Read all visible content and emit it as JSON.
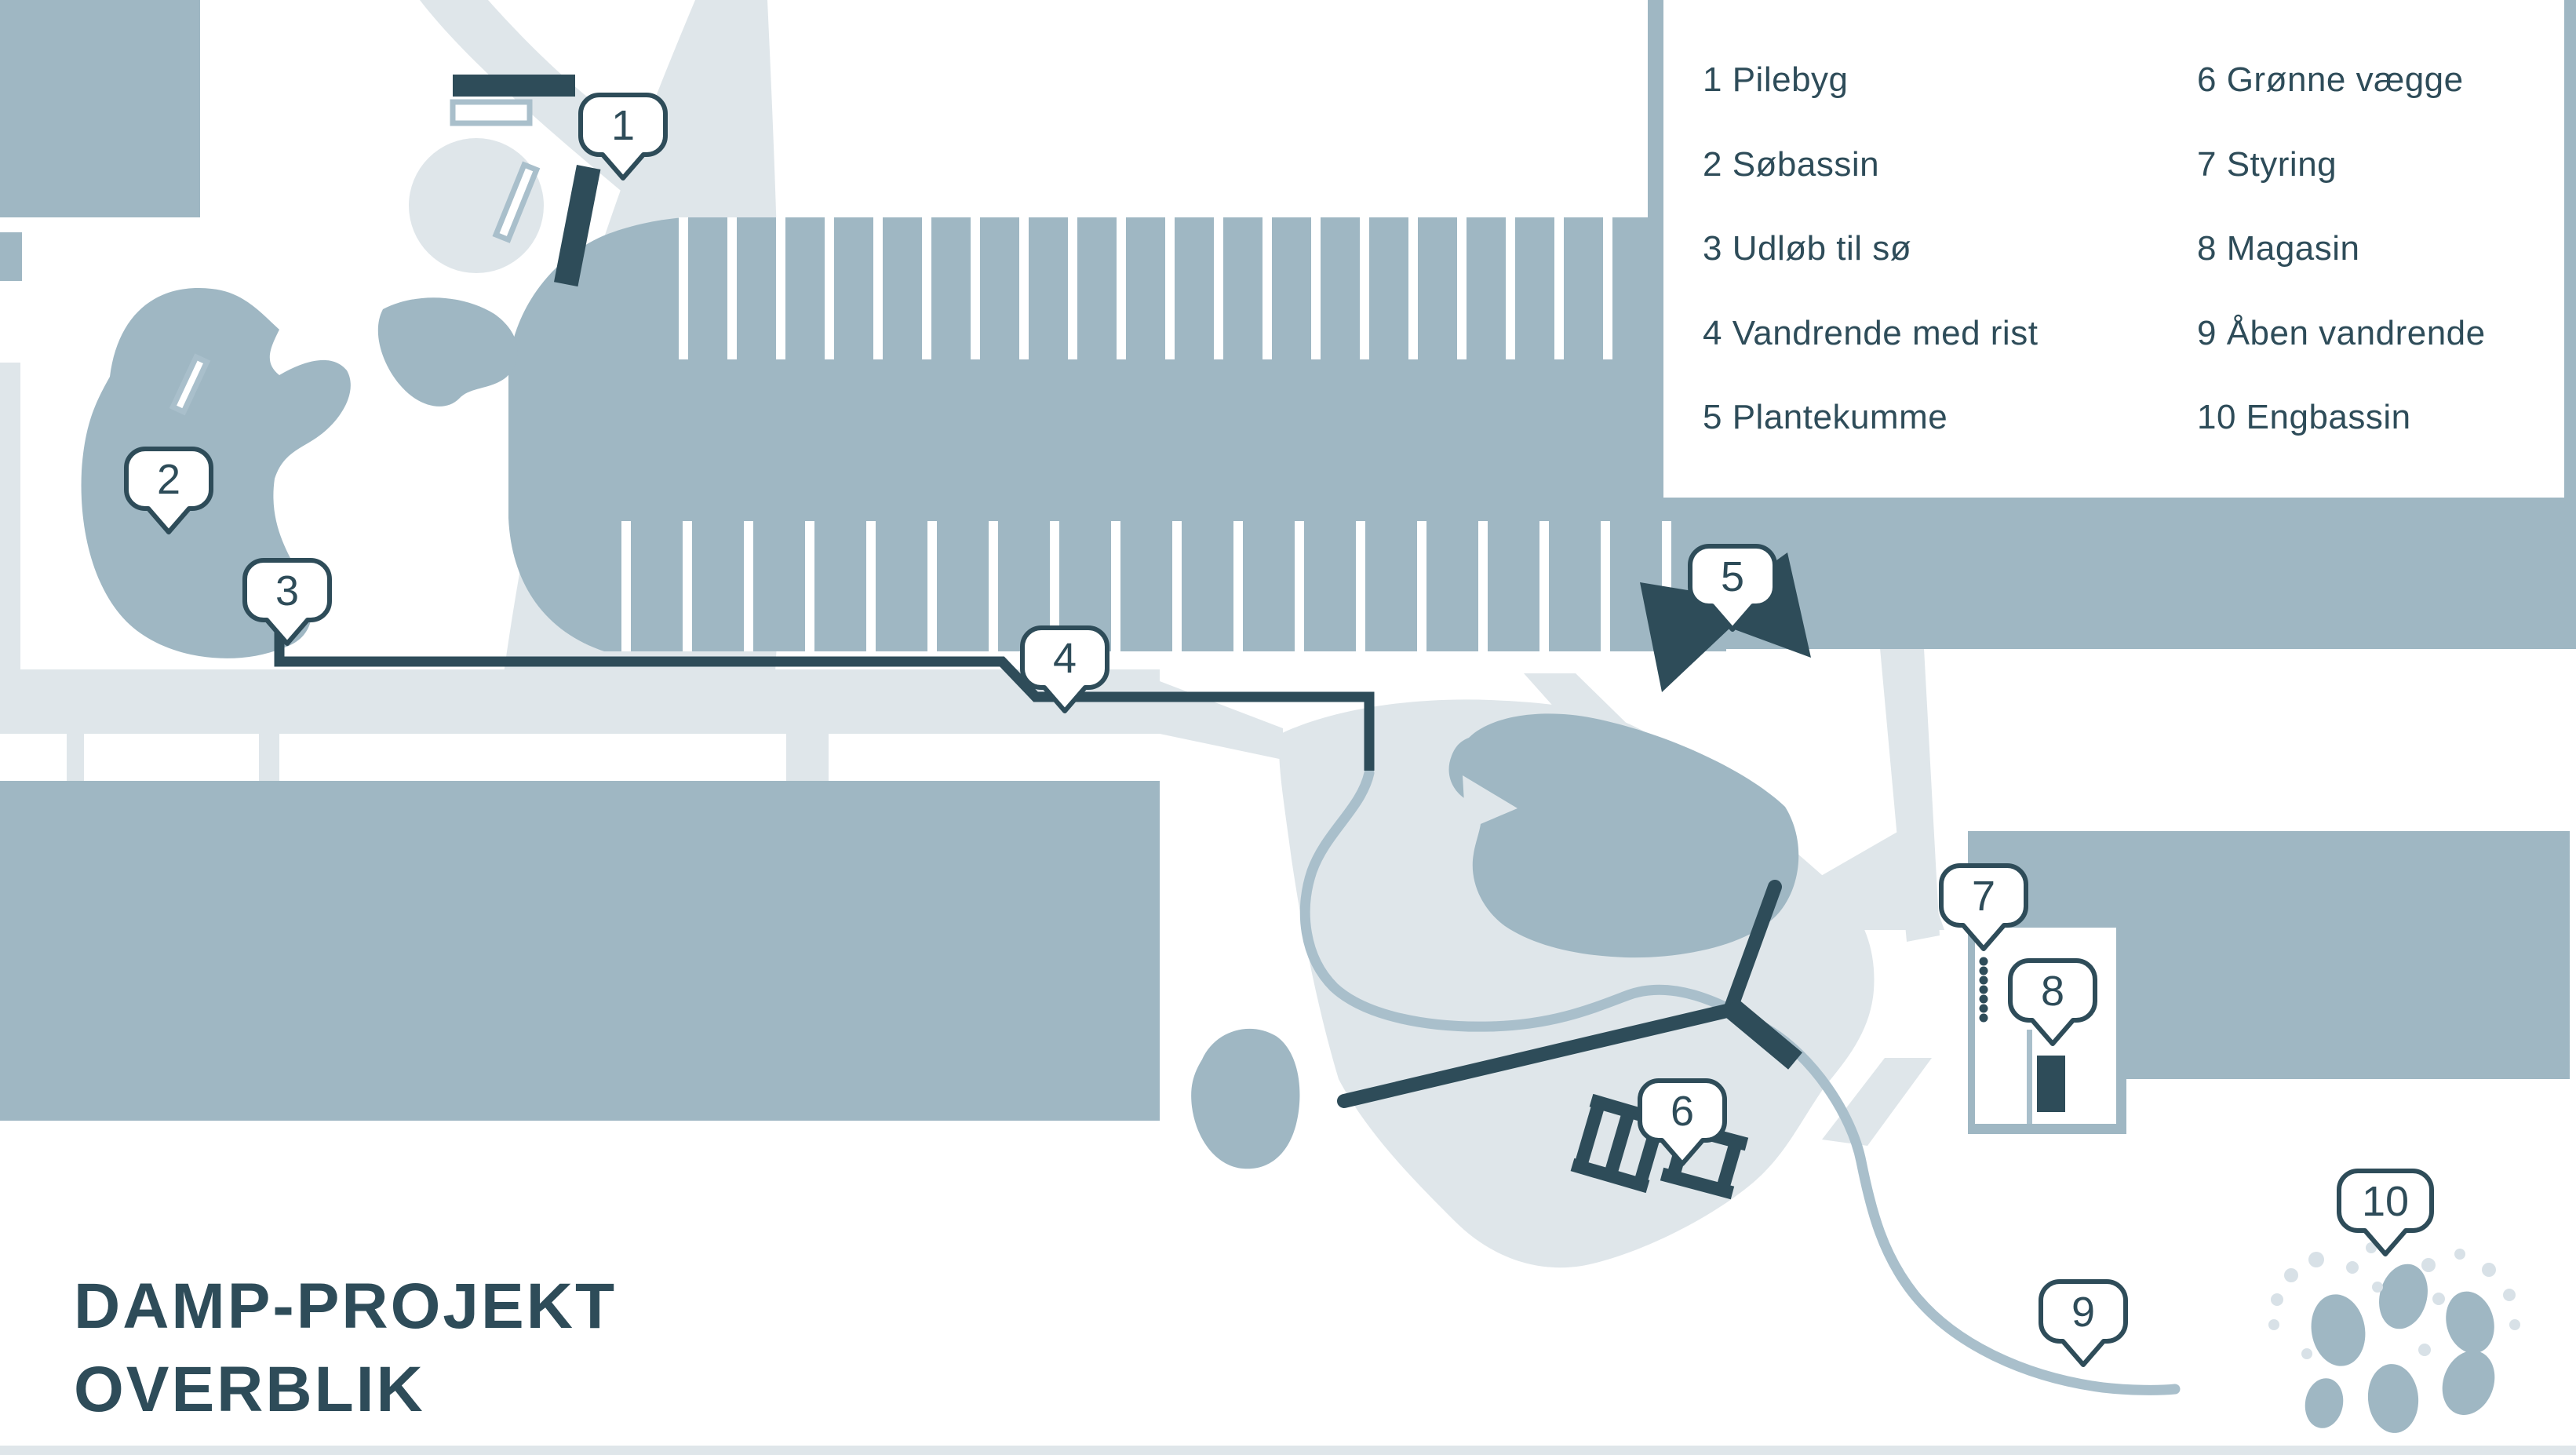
{
  "title": {
    "line1": "DAMP-PROJEKT",
    "line2": "OVERBLIK"
  },
  "legend": {
    "column1": [
      "1 Pilebyg",
      "2 Søbassin",
      "3 Udløb til sø",
      "4 Vandrende med rist",
      "5 Plantekumme"
    ],
    "column2": [
      "6 Grønne vægge",
      "7 Styring",
      "8 Magasin",
      "9 Åben vandrende",
      "10 Engbassin"
    ]
  },
  "markers": [
    {
      "number": "1"
    },
    {
      "number": "2"
    },
    {
      "number": "3"
    },
    {
      "number": "4"
    },
    {
      "number": "5"
    },
    {
      "number": "6"
    },
    {
      "number": "7"
    },
    {
      "number": "8"
    },
    {
      "number": "9"
    },
    {
      "number": "10"
    }
  ],
  "colors": {
    "ink": "#2E4C59",
    "water_blue": "#9FB7C3",
    "road_gray": "#DFE6EA",
    "stream_blue": "#A9BFCB",
    "light_dot": "#D8E1E7",
    "background": "#FFFFFF"
  }
}
